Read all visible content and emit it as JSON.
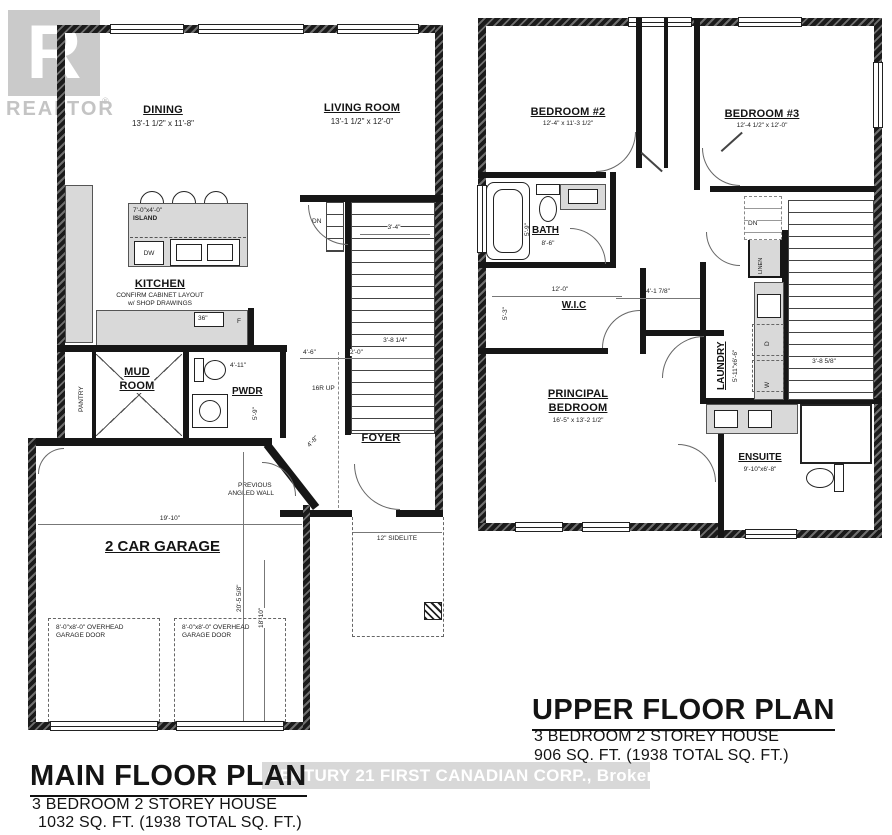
{
  "watermark": {
    "realtor_letter": "R",
    "realtor_text": "REALTOR",
    "registered": "®",
    "brokerage_bar": "CENTURY 21 FIRST CANADIAN CORP., Brokerage"
  },
  "main": {
    "title": "MAIN FLOOR PLAN",
    "subtitle1": "3 BEDROOM 2 STOREY HOUSE",
    "subtitle2": "1032 SQ. FT.  (1938 TOTAL SQ. FT.)",
    "dining": {
      "name": "DINING",
      "dims": "13'-1 1/2\" x 11'-8\""
    },
    "living": {
      "name": "LIVING ROOM",
      "dims": "13'-1 1/2\" x 12'-0\""
    },
    "kitchen": {
      "name": "KITCHEN",
      "note1": "CONFIRM CABINET LAYOUT",
      "note2": "w/ SHOP DRAWINGS"
    },
    "island": {
      "dims": "7'-0\"x4'-0\"",
      "name": "ISLAND",
      "dw": "DW",
      "range": "36\"",
      "fridge": "F"
    },
    "mud": {
      "line1": "MUD",
      "line2": "ROOM"
    },
    "pantry": "PANTRY",
    "pwdr": "PWDR",
    "foyer": "FOYER",
    "stairs": {
      "up": "16R UP",
      "dn": "DN"
    },
    "garage": {
      "name": "2 CAR GARAGE",
      "width": "19'-10\"",
      "depth1": "20'-5 5/8\"",
      "depth2": "18'-10\"",
      "door1a": "8'-0\"x8'-0\" OVERHEAD",
      "door1b": "GARAGE DOOR",
      "door2a": "8'-0\"x8'-0\" OVERHEAD",
      "door2b": "GARAGE DOOR"
    },
    "notes": {
      "prev1": "PREVIOUS",
      "prev2": "ANGLED WALL",
      "sidelite": "12\" SIDELITE"
    },
    "dims": {
      "d1": "4'-6\"",
      "d2": "2'-0\"",
      "d3": "3'-8 1/4\"",
      "d4": "3'-4\"",
      "d5": "4'-11\"",
      "d6": "5'-9\"",
      "d7": "4'-8\""
    }
  },
  "upper": {
    "title": "UPPER FLOOR PLAN",
    "subtitle1": "3 BEDROOM 2 STOREY HOUSE",
    "subtitle2": "906 SQ. FT.  (1938 TOTAL SQ. FT.)",
    "bedroom2": {
      "name": "BEDROOM #2",
      "dims": "12'-4\" x 11'-3 1/2\""
    },
    "bedroom3": {
      "name": "BEDROOM #3",
      "dims": "12'-4 1/2\" x 12'-0\""
    },
    "bath": {
      "name": "BATH",
      "width": "8'-6\"",
      "height": "5'-9\""
    },
    "wic": {
      "name": "W.I.C",
      "width": "12'-0\"",
      "height": "5'-3\""
    },
    "principal": {
      "line1": "PRINCIPAL",
      "line2": "BEDROOM",
      "dims": "16'-5\" x 13'-2 1/2\""
    },
    "laundry": {
      "name": "LAUNDRY",
      "dims": "5'-11\"x6'-6\"",
      "washer": "W",
      "dryer": "D"
    },
    "ensuite": {
      "name": "ENSUITE",
      "dims": "9'-10\"x6'-8\""
    },
    "linen": "LINEN",
    "dn": "DN",
    "dims": {
      "d1": "4'-1 7/8\"",
      "d2": "3'-8 5/8\""
    }
  }
}
